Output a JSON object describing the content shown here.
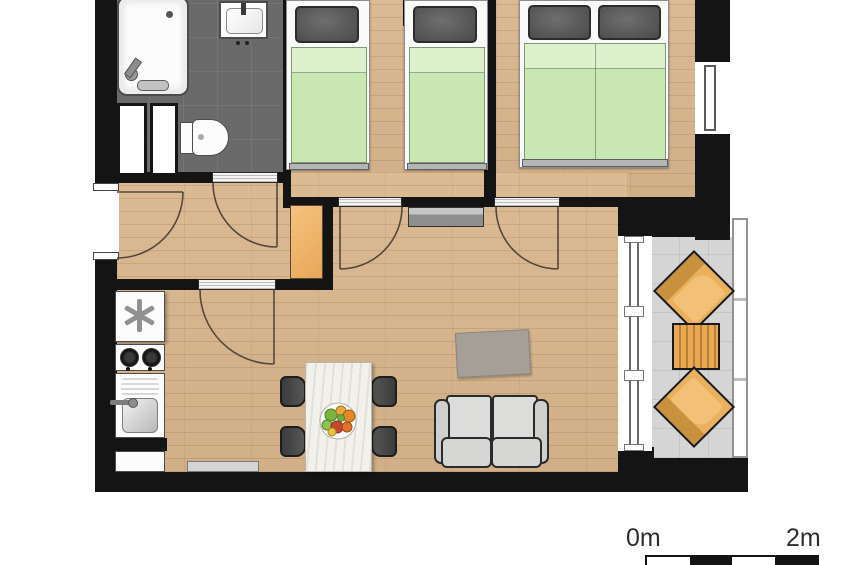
{
  "title": "apartment-floor-plan",
  "scale_bar": {
    "start_label": "0m",
    "end_label": "2m",
    "segments": 4,
    "segment_colors": [
      "#ffffff",
      "#141414",
      "#ffffff",
      "#141414"
    ]
  },
  "colors": {
    "wall": "#141414",
    "wood_floor": "#d9b68d",
    "bathroom_floor": "#6a6a6a",
    "balcony_floor": "#d5d5d5",
    "bedding_green": "#c9e7b3",
    "pillow_gray": "#5a5a5a",
    "wardrobe_orange": "#f0b469",
    "outdoor_furniture_orange": "#e9a954",
    "sofa_gray": "#d6d6d4",
    "rug_gray": "#a69f97",
    "background": "#ffffff"
  },
  "rooms": [
    {
      "name": "bathroom",
      "floor": "dark-tile",
      "fixtures": [
        "bathtub",
        "washbasin",
        "toilet",
        "duct-shafts"
      ]
    },
    {
      "name": "hall",
      "floor": "wood",
      "fixtures": [
        "wardrobe-cabinet",
        "entry-door"
      ]
    },
    {
      "name": "bedroom-1",
      "floor": "wood",
      "fixtures": [
        "single-bed",
        "single-bed"
      ]
    },
    {
      "name": "bedroom-2",
      "floor": "wood",
      "fixtures": [
        "double-bed",
        "window"
      ]
    },
    {
      "name": "kitchen-living-room",
      "floor": "wood",
      "fixtures": [
        "kitchenette",
        "dining-table",
        "four-chairs",
        "sofa",
        "rug",
        "sideboard",
        "radiator"
      ]
    },
    {
      "name": "balcony",
      "floor": "gray-tile",
      "fixtures": [
        "lounge-chair",
        "slatted-table",
        "lounge-chair",
        "railing",
        "sliding-glass-door"
      ]
    }
  ],
  "doors": [
    "entry-door",
    "bathroom-door",
    "hall-living-door",
    "bedroom-1-door",
    "bedroom-2-door"
  ],
  "windows": [
    "bedroom-2-window",
    "balcony-glass-front"
  ]
}
